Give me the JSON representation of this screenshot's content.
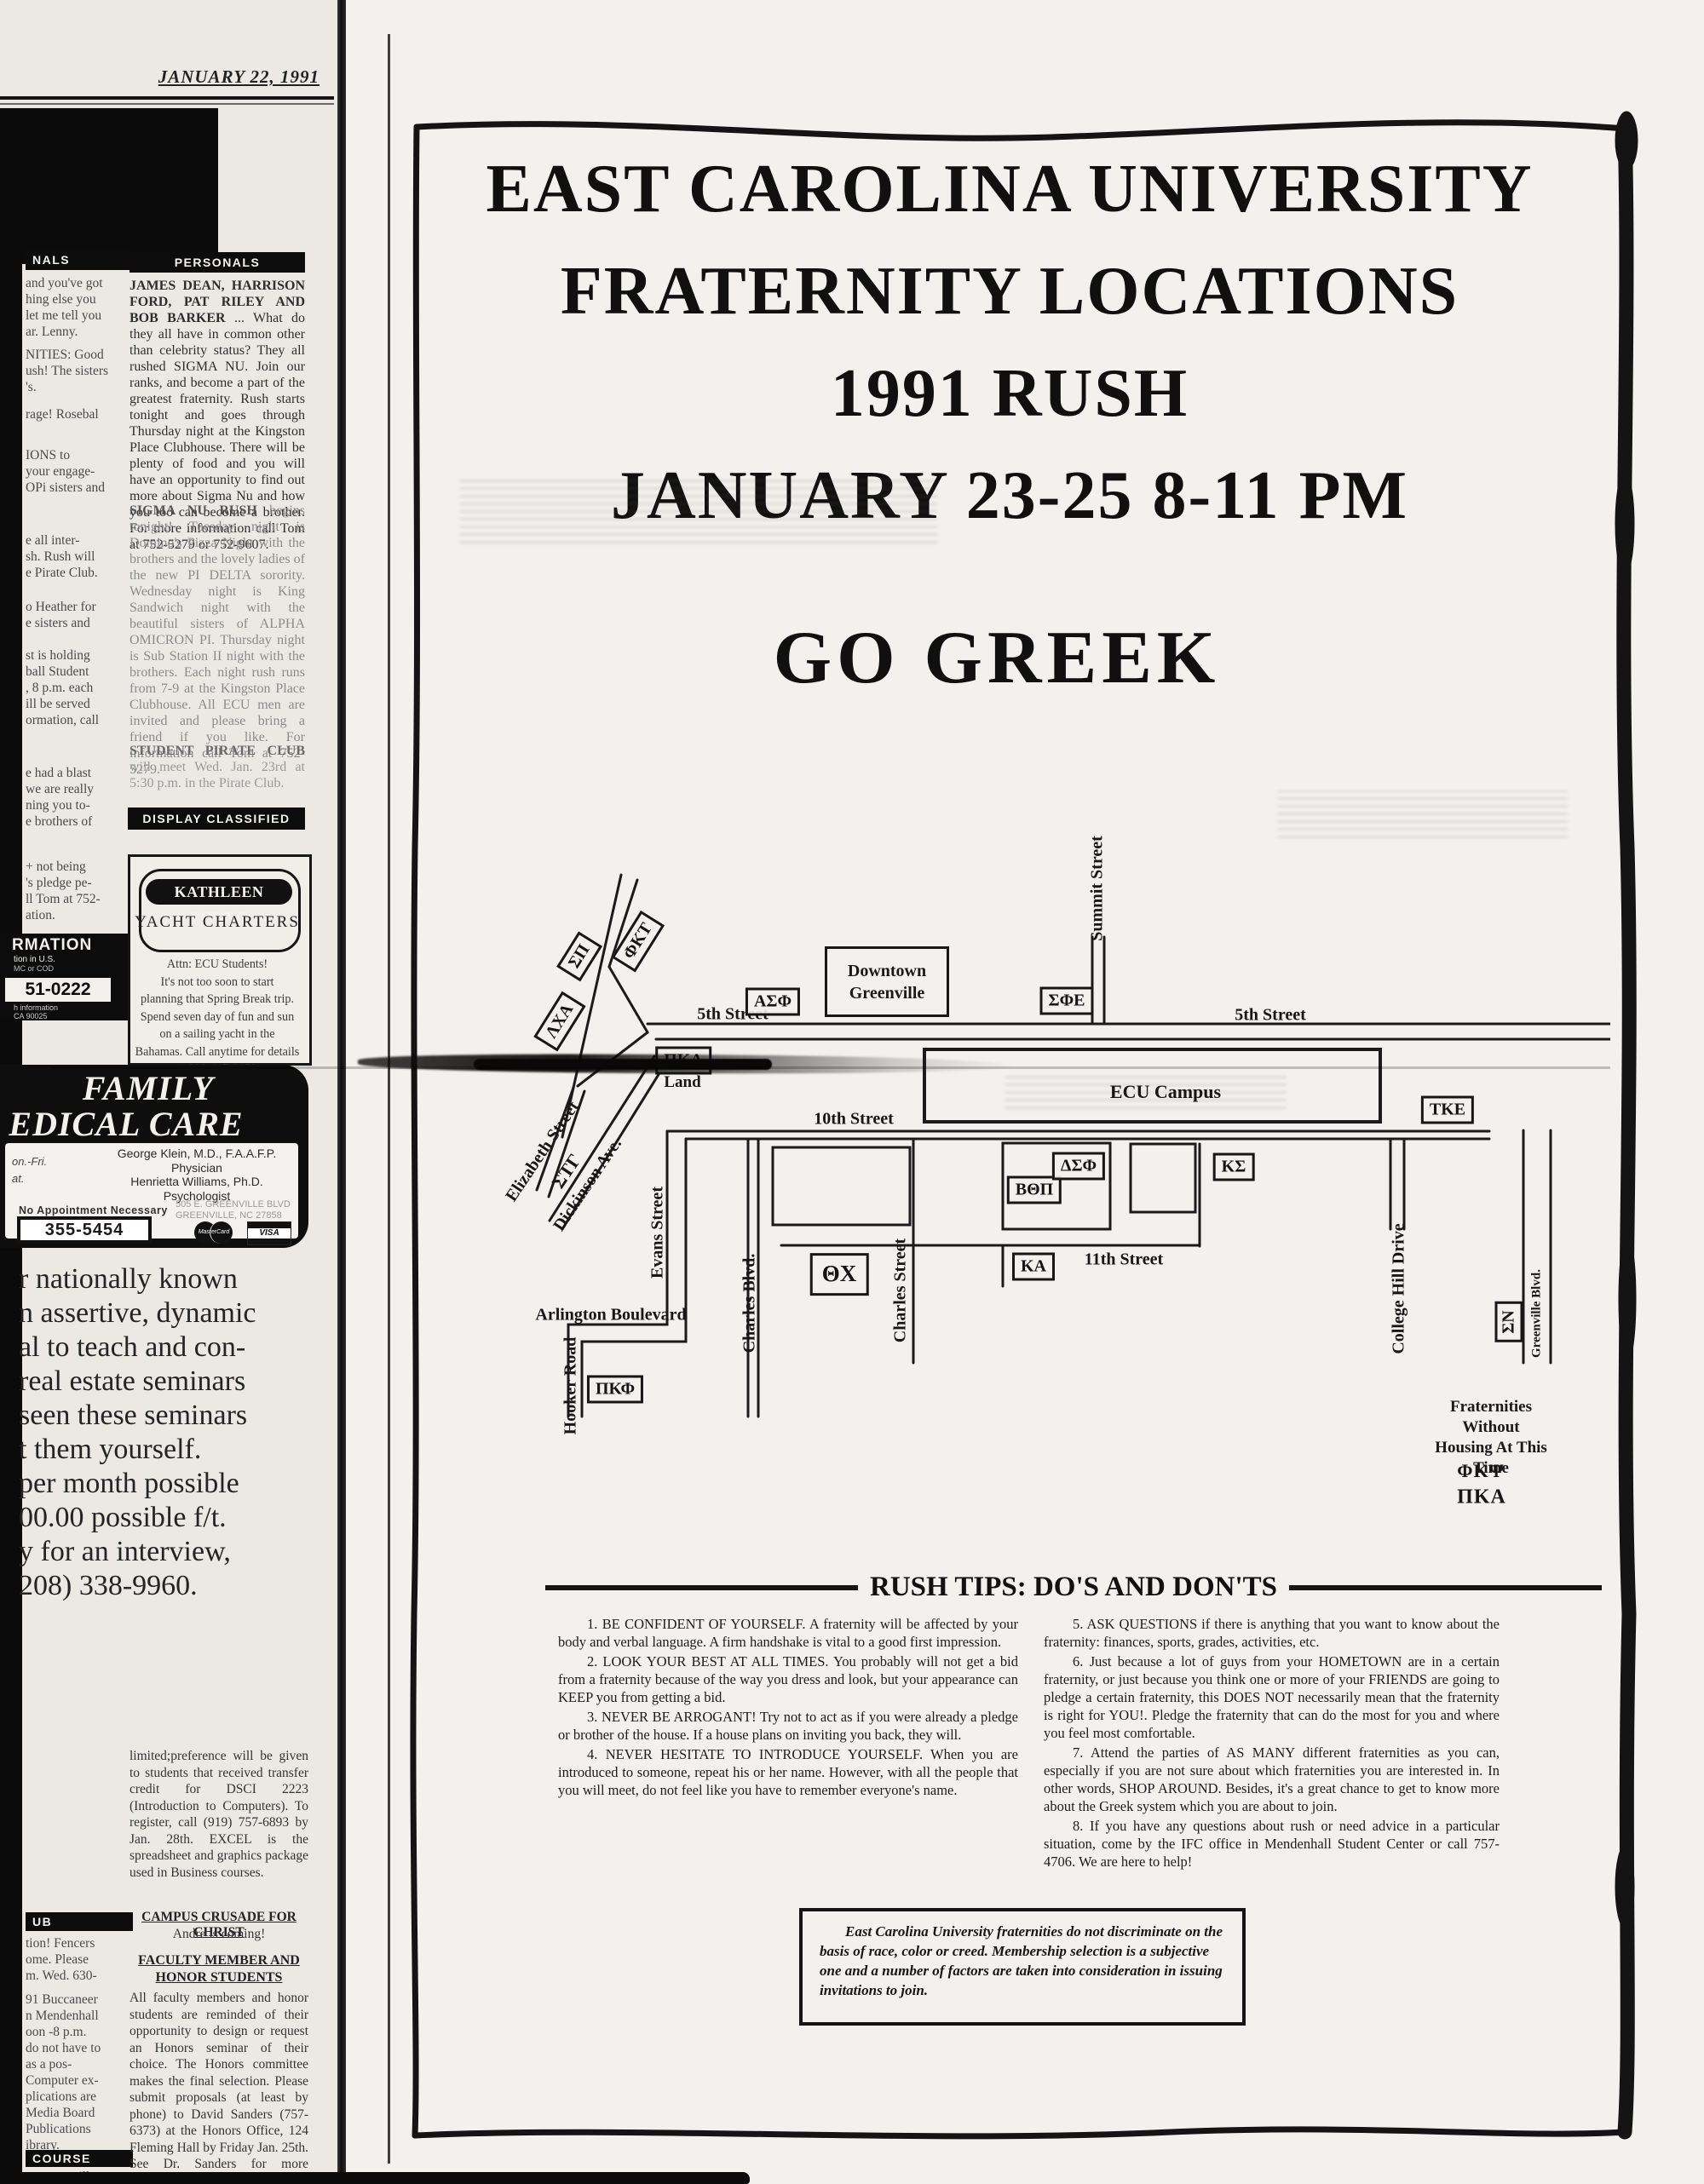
{
  "page": {
    "date": "JANUARY 22, 1991"
  },
  "left": {
    "col1": {
      "header": "NALS",
      "f1": "and you've got\nhing else you\nlet me tell you\nar.  Lenny.",
      "f2": "NITIES: Good\nush!  The sisters\n's.",
      "f3": "rage! Rosebal",
      "f4": "IONS to\nyour engage-\nOPi sisters and",
      "f5": "e all inter-\nsh.  Rush will\ne Pirate Club.",
      "f6": "o Heather for\ne sisters and",
      "f7": "st is holding\nball Student\n, 8 p.m. each\nill be served\normation, call",
      "f8": "e had a blast\nwe are really\nning you to-\ne brothers of",
      "f9": "+ not being\n's pledge pe-\nll Tom at 752-\nation.",
      "info": {
        "header": "RMATION",
        "l1": "tion in U.S.",
        "l2": "MC or COD",
        "phone": "51-0222",
        "l3": "h information",
        "l4": "CA 90025"
      }
    },
    "personals": {
      "header": "PERSONALS",
      "ads": [
        {
          "lead": "JAMES DEAN, HARRISON FORD, PAT RILEY AND BOB BARKER",
          "body": " ... What do they all have in common other than celebrity status?  They all rushed SIGMA NU. Join our ranks, and become a part of the greatest fraternity.  Rush starts tonight and goes through Thursday night at the Kingston Place Clubhouse.  There will be plenty of food and you will have an opportunity to find out more about Sigma Nu and how you too can become a brother. For more information call Tom at 752-5279 or 752-9607."
        },
        {
          "lead": "SIGMA NU RUSH",
          "body": " begins tonight! Tuesday night is Domino's Pizza Night with the brothers and the lovely ladies of the new PI DELTA sorority.  Wednesday night is King Sandwich night with the beautiful sisters of ALPHA OMICRON PI. Thursday night is Sub Station II night with the brothers.  Each night rush runs from 7-9 at the Kingston Place Clubhouse.  All ECU men are invited and please bring a friend if you like.  For information call Tom at 752-5279."
        },
        {
          "lead": "STUDENT PIRATE CLUB",
          "body": " will meet Wed. Jan. 23rd at 5:30 p.m. in the Pirate Club."
        }
      ]
    },
    "display_header": "DISPLAY CLASSIFIED",
    "yacht": {
      "name1": "KATHLEEN YOUNG",
      "name2": "YACHT CHARTERS",
      "body": "Attn: ECU Students!\nIt's not too soon to start\nplanning that Spring Break trip.\nSpend seven day of fun and sun\non a sailing yacht in the\nBahamas.  Call anytime for details\n1-800-447-2458"
    },
    "medical": {
      "title1": "FAMILY",
      "title2": "EDICAL CARE",
      "hours1": "on.-Fri.",
      "hours2": "at.",
      "staff": "George Klein, M.D., F.A.A.F.P.\nPhysician\nHenrietta Williams, Ph.D.\nPsychologist",
      "note": "No Appointment Necessary",
      "phone": "355-5454",
      "address": "505 E. GREENVILLE BLVD\nGREENVILLE, NC 27858",
      "mastercard": "MasterCard",
      "visa": "VISA"
    },
    "seminar": "r nationally known\nn assertive, dynamic\nal to teach and con-\nreal estate seminars\nseen these seminars\nt them yourself.\nper month possible\n00.00 possible f/t.\ny for an interview,\n208) 338-9960.",
    "bottom_a": {
      "header1": "UB",
      "f1": "tion!  Fencers\nome.  Please\nm. Wed. 630-",
      "f2": "91 Buccaneer\nn Mendenhall\noon -8 p.m.\ndo not have to\nas a pos-\nComputer ex-\nplications are\nMedia Board\nPublications\nibrary.",
      "header2": "COURSE",
      "f3": "artment will\nourse at no\nrollment is"
    },
    "bottom_b": {
      "p1": "limited;preference will be given to students that received transfer credit for DSCI 2223 (Introduction to Computers). To register, call (919) 757-6893 by Jan. 28th.  EXCEL is the spreadsheet and graphics package used in Business courses.",
      "crusade_title": "CAMPUS CRUSADE FOR CHRIST",
      "crusade_sub": "Andre is coming!",
      "faculty_title": "FACULTY MEMBER AND\nHONOR STUDENTS",
      "faculty_body": "All faculty members and honor students are reminded of their opportunity to design or request an Honors seminar of their choice.  The Honors committee makes the final selection. Please submit proposals (at least by phone) to David Sanders (757-6373) at the Honors Office, 124 Fleming Hall by Friday Jan. 25th.  See Dr. Sanders for more information."
    }
  },
  "ad": {
    "headline": [
      "EAST CAROLINA UNIVERSITY",
      "FRATERNITY LOCATIONS",
      "1991 RUSH",
      "JANUARY 23-25 8-11 PM"
    ],
    "subhead": "GO GREEK",
    "map": {
      "streets": {
        "fifth_left": "5th Street",
        "fifth_right": "5th Street",
        "summit": "Summit Street",
        "tenth": "10th Street",
        "eleventh": "11th Street",
        "elizabeth": "Elizabeth Street",
        "dickinson": "Dickinson Ave.",
        "evans": "Evans Street",
        "arlington": "Arlington Boulevard",
        "hooker": "Hooker Road",
        "charles_blvd": "Charles Blvd.",
        "charles_st": "Charles Street",
        "college_hill": "College Hill Drive",
        "greenville_blvd": "Greenville Blvd."
      },
      "areas": {
        "downtown": "Downtown\nGreenville",
        "campus": "ECU Campus",
        "pka_land": "Land"
      },
      "houses": {
        "sigma_pi": "ΣΠ",
        "phi_kappa_tau": "ΦΚΤ",
        "lambda_chi_alpha": "ΛΧΑ",
        "alpha_sigma_phi": "ΑΣΦ",
        "pi_kappa_alpha": "ΠΚΑ",
        "sigma_phi_epsilon": "ΣΦΕ",
        "tau_kappa_epsilon": "TKE",
        "sigma_tau_gamma": "ΣΤΓ",
        "beta_theta_pi": "ΒΘΠ",
        "delta_sigma_phi": "ΔΣΦ",
        "kappa_sigma": "ΚΣ",
        "theta_chi": "ΘΧ",
        "kappa_alpha": "ΚΑ",
        "pi_kappa_phi": "ΠΚΦ",
        "sigma_nu": "ΣΝ"
      },
      "no_housing": {
        "title": "Fraternities Without\nHousing At This Time",
        "item1": "ΦΚΨ",
        "item2": "ΠΚΑ"
      }
    },
    "rush_tips": {
      "title": "RUSH TIPS: DO'S AND DON'TS",
      "left": [
        "1.  BE CONFIDENT OF YOURSELF.  A fraternity will be affected by your body and verbal language.  A firm handshake is vital to a good first impression.",
        "2. LOOK YOUR BEST AT ALL TIMES.  You probably will not get a bid from a fraternity because of the way you dress and look, but your appearance can KEEP you from getting a bid.",
        "3.  NEVER BE ARROGANT!  Try not to act as if you were already a pledge or brother of the house.  If a house plans on inviting you back, they will.",
        "4.  NEVER HESITATE TO INTRODUCE YOURSELF.  When you are introduced to someone, repeat his or her name.  However, with all the people that you will meet, do not feel like you have to remember everyone's name."
      ],
      "right": [
        "5. ASK QUESTIONS if there is anything that you want to know about the fraternity:  finances, sports, grades, activities, etc.",
        "6.  Just because a lot of guys from your HOMETOWN are in a certain fraternity, or just because you think one or more of your FRIENDS are going to pledge a certain fraternity, this DOES NOT necessarily mean that the fraternity is right for YOU!.  Pledge the fraternity that can do the most for you and where you feel most comfortable.",
        "7.  Attend the parties of AS MANY different fraternities as you can, especially if you are not sure about which fraternities you are interested in.  In other words, SHOP AROUND.  Besides, it's a great chance to get to know more about the Greek system which you are about to join.",
        "8.  If you have any questions about rush or need advice in a particular situation, come by the IFC office in Mendenhall Student Center or call 757-4706.  We are here to help!"
      ]
    },
    "disclaimer": "East Carolina University fraternities do not discriminate on the basis of race, color or creed.  Membership selection is a subjective one and a number of factors are taken into consideration in issuing invitations to join."
  }
}
